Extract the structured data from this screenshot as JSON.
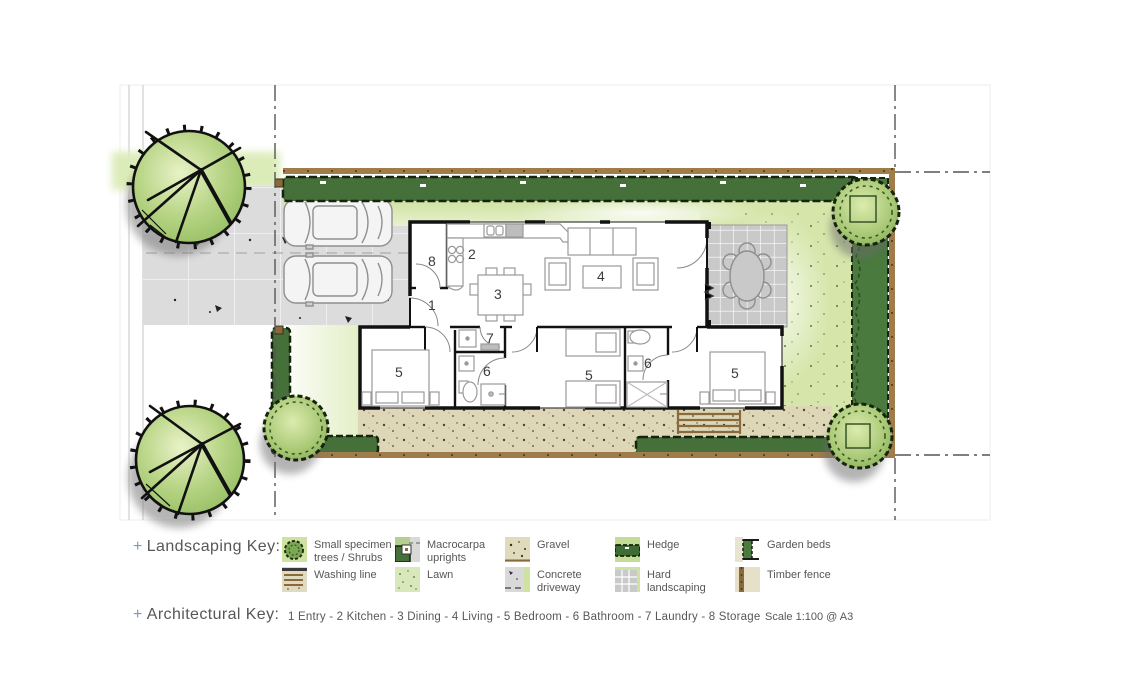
{
  "plan": {
    "room_labels": {
      "entry": "1",
      "kitchen": "2",
      "dining": "3",
      "living": "4",
      "bedroom": "5",
      "bathroom": "6",
      "laundry": "7",
      "storage": "8"
    }
  },
  "landscaping_key": {
    "plus": "+",
    "title": "Landscaping Key:",
    "items": [
      {
        "id": "small-specimen-trees",
        "label": "Small specimen trees / Shrubs"
      },
      {
        "id": "washing-line",
        "label": "Washing line"
      },
      {
        "id": "macrocarpa-uprights",
        "label": "Macrocarpa uprights"
      },
      {
        "id": "lawn",
        "label": "Lawn"
      },
      {
        "id": "gravel",
        "label": "Gravel"
      },
      {
        "id": "concrete-driveway",
        "label": "Concrete driveway"
      },
      {
        "id": "hedge",
        "label": "Hedge"
      },
      {
        "id": "hard-landscaping",
        "label": "Hard landscaping"
      },
      {
        "id": "garden-beds",
        "label": "Garden beds"
      },
      {
        "id": "timber-fence",
        "label": "Timber fence"
      }
    ]
  },
  "architectural_key": {
    "plus": "+",
    "title": "Architectural Key:",
    "legend": "1 Entry - 2 Kitchen - 3 Dining - 4 Living - 5 Bedroom - 6 Bathroom - 7 Laundry - 8 Storage",
    "scale": "Scale 1:100 @ A3"
  },
  "colors": {
    "accent_blue": "#6e9bd2",
    "hedge_green": "#45703a",
    "lawn_green": "#d6e6ab",
    "gravel_beige": "#ddd7b8",
    "concrete_grey": "#dcdcdc",
    "fence_brown": "#9a7648",
    "text_grey": "#575756"
  }
}
